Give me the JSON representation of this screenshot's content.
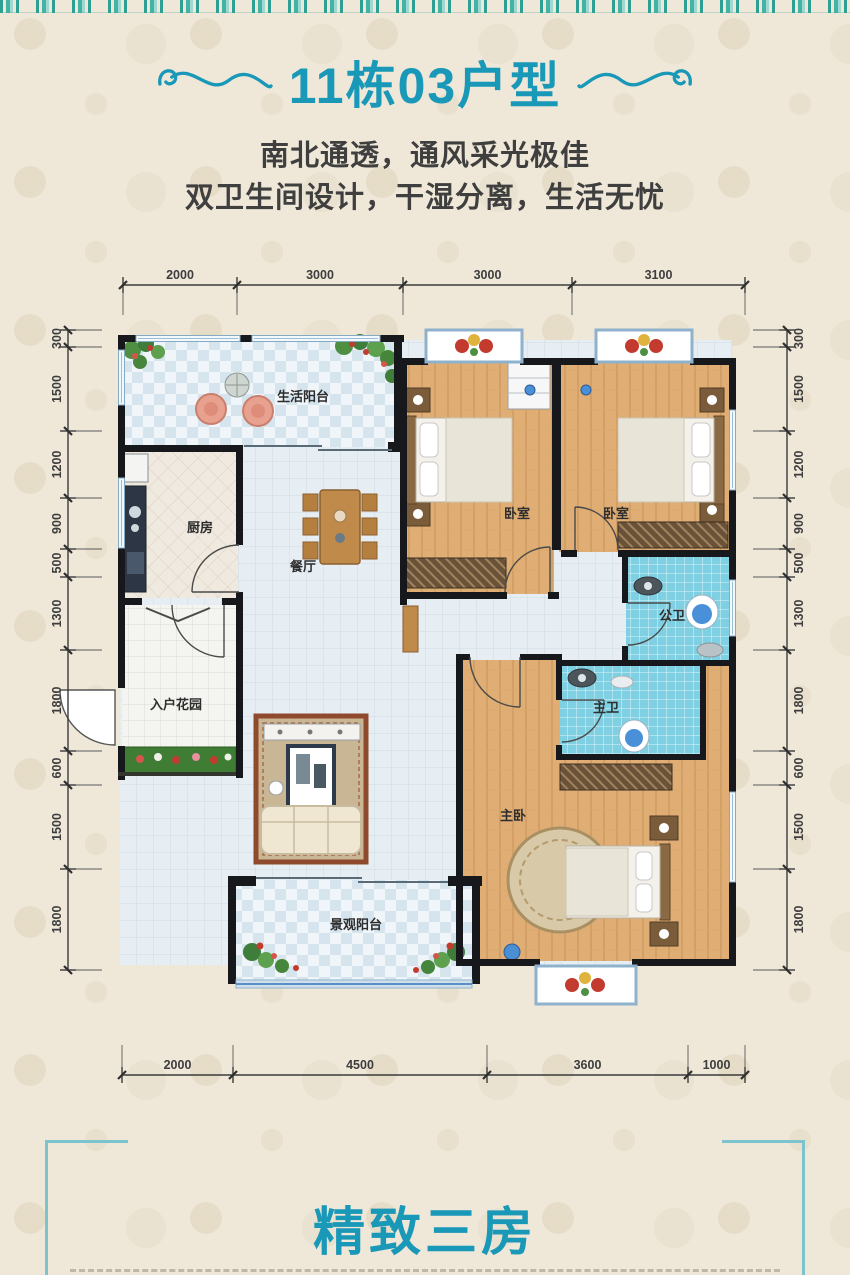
{
  "header": {
    "title": "11栋03户型",
    "subtitle1": "南北通透，通风采光极佳",
    "subtitle2": "双卫生间设计，干湿分离，生活无忧"
  },
  "footer": {
    "title": "精致三房"
  },
  "colors": {
    "accent_teal": "#1a98b8",
    "frame_teal": "#7cc4cd",
    "wall_black": "#17181c",
    "wood_floor": "#e0ae74",
    "bath_tile": "#7ed0e2",
    "balcony_check": "#d5e4ed",
    "planter_green": "#3f7d35",
    "dim_text": "#3d3d3d"
  },
  "floorplan": {
    "rooms": [
      {
        "label": "生活阳台",
        "x": 303,
        "y": 161
      },
      {
        "label": "厨房",
        "x": 200,
        "y": 292
      },
      {
        "label": "餐厅",
        "x": 303,
        "y": 331
      },
      {
        "label": "卧室",
        "x": 517,
        "y": 278
      },
      {
        "label": "卧室",
        "x": 616,
        "y": 278
      },
      {
        "label": "公卫",
        "x": 672,
        "y": 380
      },
      {
        "label": "主卫",
        "x": 606,
        "y": 472
      },
      {
        "label": "主卧",
        "x": 513,
        "y": 580
      },
      {
        "label": "入户花园",
        "x": 176,
        "y": 469
      },
      {
        "label": "景观阳台",
        "x": 356,
        "y": 689
      }
    ],
    "dimensions": {
      "top": {
        "axis": "h",
        "line": 45,
        "ticks": [
          123,
          237,
          403,
          572,
          745
        ],
        "labels": [
          "2000",
          "3000",
          "3000",
          "3100"
        ]
      },
      "bottom": {
        "axis": "h",
        "line": 835,
        "ticks": [
          122,
          233,
          487,
          688,
          745
        ],
        "labels": [
          "2000",
          "4500",
          "3600",
          "1000"
        ]
      },
      "left": {
        "axis": "v",
        "line": 68,
        "ticks": [
          90,
          107,
          191,
          258,
          309,
          337,
          410,
          511,
          545,
          629,
          730
        ],
        "labels": [
          "300",
          "1500",
          "1200",
          "900",
          "500",
          "1300",
          "1800",
          "600",
          "1500",
          "1800"
        ]
      },
      "right": {
        "axis": "v",
        "line": 787,
        "ticks": [
          90,
          107,
          191,
          258,
          309,
          337,
          410,
          511,
          545,
          629,
          730
        ],
        "labels": [
          "300",
          "1500",
          "1200",
          "900",
          "500",
          "1300",
          "1800",
          "600",
          "1500",
          "1800"
        ]
      }
    }
  }
}
